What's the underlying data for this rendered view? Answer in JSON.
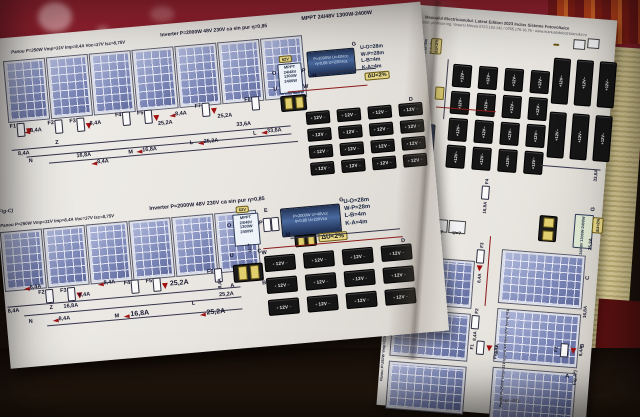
{
  "labels": {
    "battery": "12V",
    "plus": "+",
    "minus": "−"
  },
  "du": "ΔU<2%",
  "uq": "U=?",
  "mppt": {
    "v": "62V",
    "l1": "MPPT",
    "l2": "24/48V",
    "l3": "1300W",
    "l4": "2400W"
  },
  "inverter_box": {
    "l1": "P=2000W U=48Vcc",
    "l2": "η=0,85  U=230Vca"
  },
  "runs": {
    "r1": "U-O=28m",
    "r2": "W-P=28m",
    "r3": "L-B=4m",
    "r4": "K-A=4m"
  },
  "runs_right": {
    "r1": "U-O=28m",
    "r2": "W-P=28m",
    "r3": "L-B=8m",
    "r4": "K-A=8m"
  },
  "specs": {
    "panou": "Panou P=250W Vmp=31V Imp=8,4A Voc=37V Isc=8,75V",
    "inverter": "Inverter P=2000W 48V 230V ca sin pur η=0,85",
    "mppt": "MPPT 24/48V 1300W-2400W"
  },
  "currents": {
    "c84": "8,4A",
    "c168": "16,8A",
    "c252": "25,2A",
    "c336": "33,6A"
  },
  "fuses": {
    "f1": "F1",
    "f2": "F2",
    "f3": "F3",
    "f4": "F4",
    "f5": "F5",
    "f6": "F6",
    "f7": "F7",
    "f8": "F8"
  },
  "letters": {
    "a": "A",
    "b": "B",
    "c": "C",
    "d": "D",
    "e": "E",
    "g": "G",
    "h": "H",
    "k": "K",
    "l": "L",
    "m": "M",
    "n": "N",
    "o": "O",
    "p": "P",
    "u": "U",
    "w": "W",
    "z": "Z"
  },
  "figs": {
    "c": "(Fig-C)",
    "a": "Fig.A)",
    "a2": "Fig.A*)"
  },
  "right_page": {
    "title1": "Manualul Electricianului. Latest Edition 2023 Inclus Sisteme Fotovoltaice",
    "title2": "autor: profesor ing. Ursanu Mircea 0723.183.142 / 0765.176.16.76 - www.manualulelectricianului.ro",
    "page_number": "Page 483",
    "inverter": "P=2000W U=48Vcc η=0,85 U=230Vca"
  }
}
